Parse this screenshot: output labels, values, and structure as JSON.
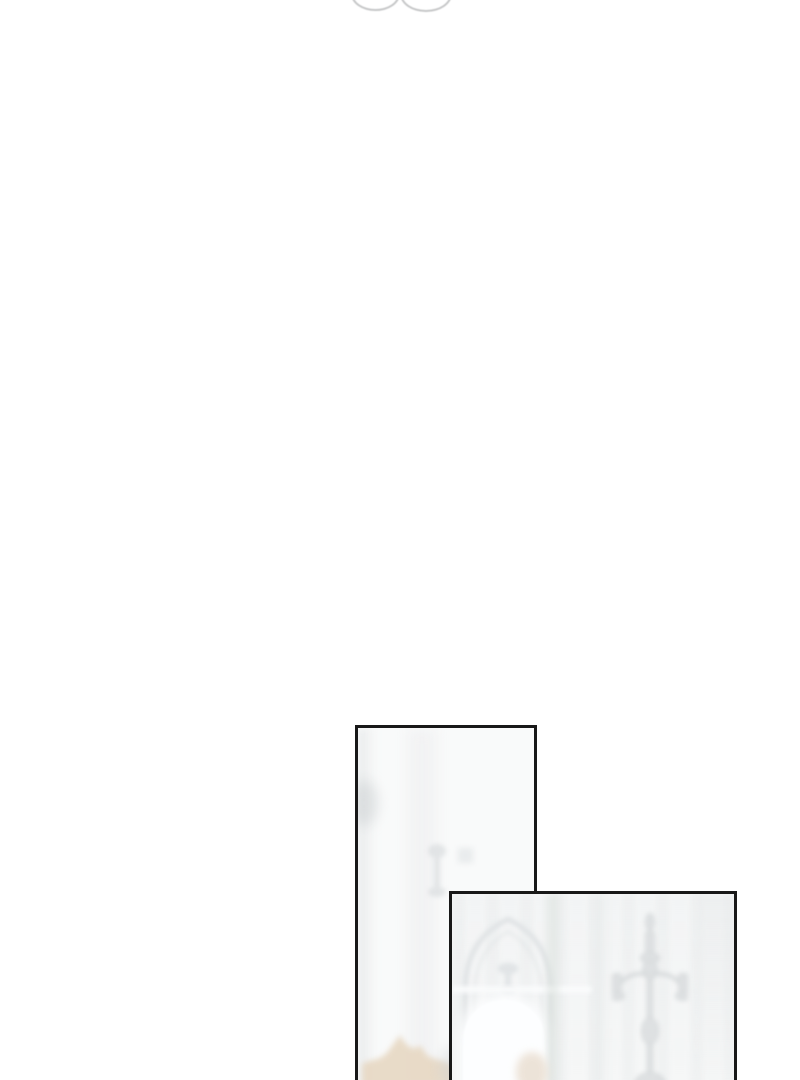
{
  "page": {
    "type": "webtoon-comic-strip-view",
    "visible_text": "none"
  },
  "top_fragment": {
    "description": "Bottom arcs of two overlapping rounded shapes from the previous panel, cut off by the top edge of the viewport"
  },
  "panels": [
    {
      "id": "panel-1",
      "description": "Tall narrow panel, mostly blank bright interior; faint gray washes, a faint goblet silhouette, and a blurred beige hair shape entering from the bottom; panel continues past the bottom edge"
    },
    {
      "id": "panel-2",
      "description": "Wider panel overlapping the first; faint washed-out palace interior with a pointed-arch alcove, a bright white arch-top window, wall paneling bands, a silver candelabra, and a soft beige ornament at the bottom; panel continues past the bottom edge"
    }
  ],
  "colors": {
    "page_bg": "#ffffff",
    "panel_border": "#181818",
    "panel1_bg": "#f9fafa",
    "panel2_bg": "#f6f7f7",
    "arc_stroke": "#c6c7c8",
    "faint_gray": "#dcdfe1",
    "beige": "#e7d8c3",
    "beige_soft": "#eadfd2",
    "window_white": "#fdfeff"
  }
}
